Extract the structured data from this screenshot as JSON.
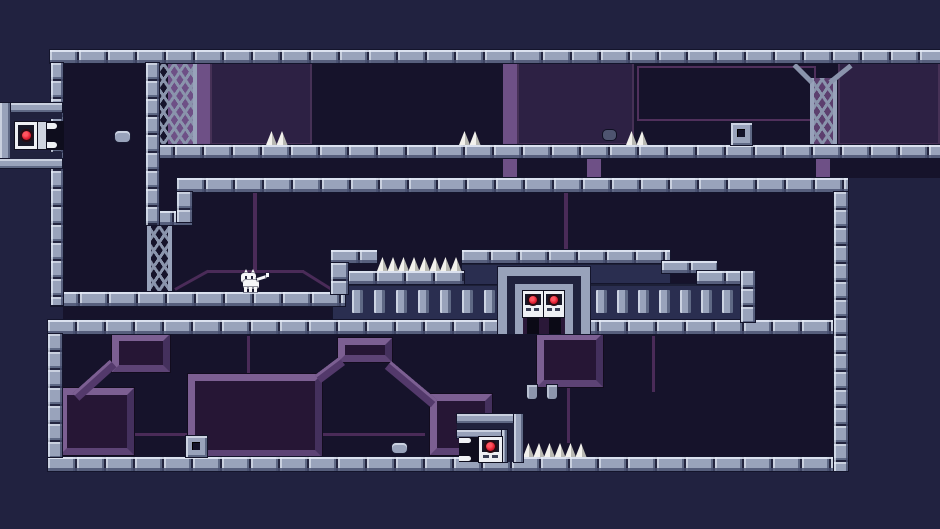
{
  "scene": {
    "width": 940,
    "height": 529,
    "kind": "pixel-platformer-level"
  },
  "palette": {
    "outer_bg": "#212240",
    "room_bg": "#16132b",
    "fence_face": "#2a2e50",
    "brick_body": "#99a3bb",
    "brick_light": "#c9d0df",
    "brick_dark": "#5f6985",
    "mortar": "#23253f",
    "purple_column": "#6e5086",
    "purple_panel": "#2d2144",
    "purple_line": "#4a2b58",
    "decor_block_face": "#261635",
    "decor_bevel_light": "#7c5f92",
    "truss_gray": "#8a94ac",
    "truss_purple_fill": "#5c3f6e",
    "spike_white": "#f2f1ec",
    "indicator_red": "#e01d30",
    "panel_white": "#eef0f4"
  },
  "rooms": [
    {
      "name": "upper-room-interior",
      "x": 63,
      "y": 63,
      "w": 877,
      "h": 115
    },
    {
      "name": "left-shaft-interior",
      "x": 63,
      "y": 178,
      "w": 114,
      "h": 142
    },
    {
      "name": "middle-room-interior",
      "x": 177,
      "y": 192,
      "w": 657,
      "h": 128
    },
    {
      "name": "bottom-room-interior",
      "x": 62,
      "y": 334,
      "w": 772,
      "h": 123
    }
  ],
  "decor": {
    "columns": [
      {
        "x": 168,
        "y": 62,
        "w": 42,
        "h": 83
      },
      {
        "x": 503,
        "y": 62,
        "w": 14,
        "h": 116
      },
      {
        "x": 587,
        "y": 145,
        "w": 14,
        "h": 33
      },
      {
        "x": 816,
        "y": 158,
        "w": 14,
        "h": 20
      }
    ],
    "panels": [
      {
        "x": 210,
        "y": 62,
        "w": 102,
        "h": 83
      },
      {
        "x": 517,
        "y": 62,
        "w": 117,
        "h": 83
      },
      {
        "x": 838,
        "y": 62,
        "w": 102,
        "h": 83
      }
    ],
    "outlines": [
      {
        "x": 637,
        "y": 66,
        "w": 175,
        "h": 51
      }
    ],
    "lines": [
      {
        "x": 253,
        "y": 192,
        "w": 4,
        "h": 80
      },
      {
        "x": 207,
        "y": 270,
        "w": 97,
        "h": 3
      },
      {
        "x": 564,
        "y": 192,
        "w": 4,
        "h": 58
      },
      {
        "x": 567,
        "y": 387,
        "w": 3,
        "h": 56
      },
      {
        "x": 80,
        "y": 433,
        "w": 345,
        "h": 3
      },
      {
        "x": 247,
        "y": 336,
        "w": 3,
        "h": 38
      },
      {
        "x": 652,
        "y": 336,
        "w": 3,
        "h": 56
      }
    ],
    "diag_lines": [
      {
        "x": 175,
        "y": 288,
        "len": 38,
        "deg": -29
      },
      {
        "x": 303,
        "y": 270,
        "len": 33,
        "deg": 32
      }
    ],
    "blocks": [
      {
        "x": 112,
        "y": 334,
        "w": 58,
        "h": 38
      },
      {
        "x": 60,
        "y": 388,
        "w": 74,
        "h": 67
      },
      {
        "x": 188,
        "y": 374,
        "w": 134,
        "h": 83
      },
      {
        "x": 338,
        "y": 338,
        "w": 54,
        "h": 24
      },
      {
        "x": 430,
        "y": 394,
        "w": 62,
        "h": 61
      },
      {
        "x": 537,
        "y": 333,
        "w": 66,
        "h": 54
      }
    ],
    "diag_bands": [
      {
        "x": 76,
        "y": 392,
        "len": 50,
        "deg": -42
      },
      {
        "x": 318,
        "y": 374,
        "len": 30,
        "deg": -37
      },
      {
        "x": 388,
        "y": 360,
        "len": 60,
        "deg": 40
      }
    ]
  },
  "trusses": [
    {
      "name": "upper-left-truss",
      "x": 151,
      "y": 63,
      "w": 46,
      "h": 82,
      "purple": false,
      "arms": []
    },
    {
      "name": "shaft-truss",
      "x": 147,
      "y": 225,
      "w": 25,
      "h": 67,
      "purple": false,
      "arms": []
    },
    {
      "name": "upper-right-truss",
      "x": 810,
      "y": 78,
      "w": 27,
      "h": 67,
      "purple": true,
      "arms": [
        {
          "x": 812,
          "y": 80,
          "len": 25,
          "deg": -135
        },
        {
          "x": 830,
          "y": 80,
          "len": 27,
          "deg": -39
        }
      ]
    }
  ],
  "faces": [
    {
      "x": 333,
      "y": 284,
      "w": 167,
      "h": 36
    },
    {
      "x": 462,
      "y": 263,
      "w": 208,
      "h": 21
    },
    {
      "x": 500,
      "y": 268,
      "w": 90,
      "h": 52
    },
    {
      "x": 590,
      "y": 284,
      "w": 165,
      "h": 36
    }
  ],
  "slats": {
    "y": 290,
    "w": 11,
    "h": 23,
    "xs": [
      352,
      374,
      396,
      418,
      440,
      462,
      484,
      596,
      617,
      638,
      659,
      680,
      701,
      722
    ]
  },
  "platforms": [
    {
      "name": "top-ceiling",
      "x": 50,
      "y": 50,
      "w": 890,
      "h": 13
    },
    {
      "name": "upper-floor",
      "x": 146,
      "y": 145,
      "w": 794,
      "h": 13
    },
    {
      "name": "mid-floor",
      "x": 177,
      "y": 178,
      "w": 671,
      "h": 14
    },
    {
      "name": "cat-ledge",
      "x": 51,
      "y": 292,
      "w": 294,
      "h": 14
    },
    {
      "name": "main-floor",
      "x": 48,
      "y": 320,
      "w": 800,
      "h": 14
    },
    {
      "name": "bottom-floor",
      "x": 48,
      "y": 457,
      "w": 800,
      "h": 14
    },
    {
      "name": "wall-cap",
      "x": 145,
      "y": 211,
      "w": 47,
      "h": 14
    },
    {
      "name": "tower-cap",
      "x": 331,
      "y": 250,
      "w": 46,
      "h": 13
    },
    {
      "name": "spike-ledge",
      "x": 348,
      "y": 271,
      "w": 116,
      "h": 13
    },
    {
      "name": "gate-top",
      "x": 462,
      "y": 250,
      "w": 208,
      "h": 13
    },
    {
      "name": "step-one",
      "x": 662,
      "y": 261,
      "w": 55,
      "h": 12
    },
    {
      "name": "step-two",
      "x": 697,
      "y": 271,
      "w": 58,
      "h": 13
    }
  ],
  "walls": [
    {
      "name": "left-wall",
      "x": 51,
      "y": 63,
      "w": 12,
      "h": 242
    },
    {
      "name": "shaft-wall",
      "x": 146,
      "y": 63,
      "w": 13,
      "h": 162
    },
    {
      "name": "mid-floor-left-col",
      "x": 177,
      "y": 192,
      "w": 15,
      "h": 30
    },
    {
      "name": "right-wall",
      "x": 834,
      "y": 192,
      "w": 14,
      "h": 279
    },
    {
      "name": "bottom-left-wall",
      "x": 48,
      "y": 334,
      "w": 14,
      "h": 123
    },
    {
      "name": "tower-col",
      "x": 331,
      "y": 263,
      "w": 17,
      "h": 31
    },
    {
      "name": "fence-right-col",
      "x": 741,
      "y": 271,
      "w": 14,
      "h": 51
    }
  ],
  "spike_groups": [
    {
      "x": 266,
      "y": 131,
      "count": 2
    },
    {
      "x": 459,
      "y": 131,
      "count": 2
    },
    {
      "x": 626,
      "y": 131,
      "count": 2
    },
    {
      "x": 377,
      "y": 257,
      "count": 8
    },
    {
      "x": 523,
      "y": 443,
      "count": 6
    }
  ],
  "tiles": [
    {
      "x": 731,
      "y": 123,
      "w": 21,
      "h": 22
    },
    {
      "x": 186,
      "y": 436,
      "w": 21,
      "h": 21
    }
  ],
  "bullets": [
    {
      "x": 115,
      "y": 131,
      "w": 15,
      "h": 11,
      "dark": false
    },
    {
      "x": 603,
      "y": 130,
      "w": 13,
      "h": 10,
      "dark": true
    },
    {
      "x": 392,
      "y": 443,
      "w": 15,
      "h": 10,
      "dark": false
    }
  ],
  "pegs": [
    {
      "x": 527,
      "y": 385,
      "w": 10,
      "h": 14
    },
    {
      "x": 547,
      "y": 385,
      "w": 10,
      "h": 14
    }
  ],
  "gate": {
    "x": 498,
    "y": 267,
    "w": 92,
    "h": 67,
    "panel_count": 2
  },
  "exit_left": {
    "x": 0,
    "y": 103,
    "w": 64,
    "h": 65
  },
  "exit_bottom": {
    "x": 457,
    "y": 414,
    "w": 66,
    "h": 48
  },
  "player": {
    "x": 240,
    "y": 268,
    "w": 30,
    "h": 24,
    "type": "cat"
  }
}
